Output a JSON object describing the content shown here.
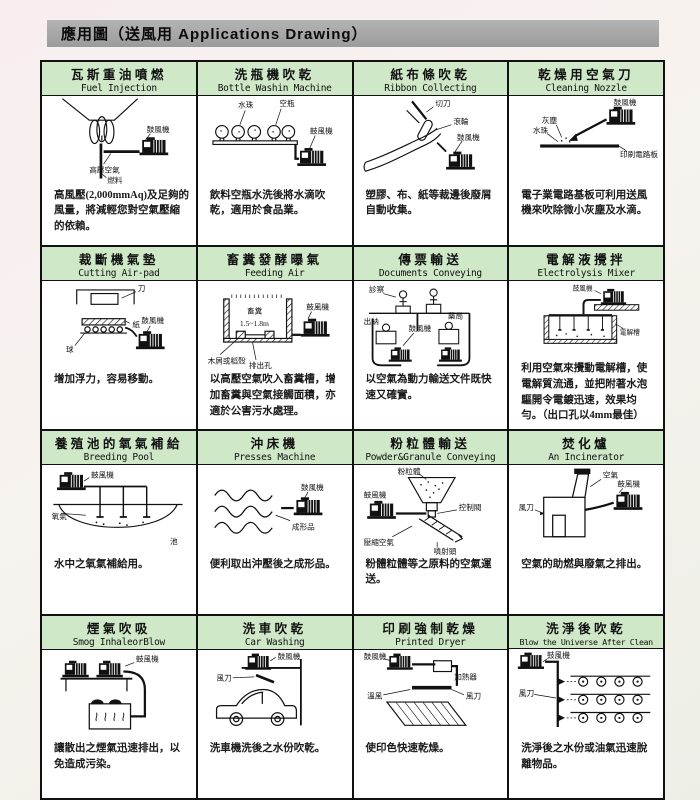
{
  "page": {
    "title": "應用圖（送風用 Applications Drawing）"
  },
  "colors": {
    "header_bar": "#a3a3a3",
    "title_band": "#cfe8c8",
    "border": "#111111",
    "paper": "#ffffff"
  },
  "cells": [
    {
      "title_zh": "瓦斯重油噴燃",
      "title_en": "Fuel Injection",
      "labels": [
        "鼓風機",
        "高壓空氣",
        "燃料"
      ],
      "desc": "高風壓(2,000mmAq)及足夠的風量，將減輕您對空氣壓縮的依賴。"
    },
    {
      "title_zh": "洗瓶機吹乾",
      "title_en": "Bottle Washin Machine",
      "labels": [
        "水珠",
        "空瓶",
        "鼓風機"
      ],
      "desc": "飲料空瓶水洗後將水滴吹乾，適用於食品業。"
    },
    {
      "title_zh": "紙布條吹乾",
      "title_en": "Ribbon Collecting",
      "labels": [
        "切刀",
        "滾輪",
        "鼓風機"
      ],
      "desc": "塑膠、布、紙等裁邊後廢屑自動收集。"
    },
    {
      "title_zh": "乾燥用空氣刀",
      "title_en": "Cleaning Nozzle",
      "labels": [
        "鼓風機",
        "灰塵",
        "水珠",
        "印刷電路板"
      ],
      "desc": "電子業電路基板可利用送風機來吹除微小灰塵及水滴。"
    },
    {
      "title_zh": "裁斷機氣墊",
      "title_en": "Cutting Air-pad",
      "labels": [
        "刀",
        "紙",
        "鼓風機",
        "球"
      ],
      "desc": "增加浮力，容易移動。"
    },
    {
      "title_zh": "畜糞發酵曝氣",
      "title_en": "Feeding Air",
      "labels": [
        "畜糞",
        "1.5~1.8m",
        "鼓風機",
        "木屑或稻殼",
        "排出孔"
      ],
      "desc": "以高壓空氣吹入畜糞槽，增加畜糞與空氣接觸面積，亦適於公害污水處理。"
    },
    {
      "title_zh": "傳票輸送",
      "title_en": "Documents Conveying",
      "labels": [
        "診察",
        "出納",
        "鼓風機",
        "藥局"
      ],
      "desc": "以空氣為動力輸送文件既快速又確實。"
    },
    {
      "title_zh": "電解液攪拌",
      "title_en": "Electrolysis Mixer",
      "labels": [
        "鼓風機",
        "電解槽"
      ],
      "desc": "利用空氣來攪動電解槽，使電解質流通，並把附著水泡驅開令電鍍迅速，效果均勻。（出口孔以4mm最佳）"
    },
    {
      "title_zh": "養殖池的氧氣補給",
      "title_en": "Breeding Pool",
      "labels": [
        "鼓風機",
        "氧氣",
        "池"
      ],
      "desc": "水中之氧氣補給用。"
    },
    {
      "title_zh": "沖床機",
      "title_en": "Presses Machine",
      "labels": [
        "鼓風機",
        "成形品"
      ],
      "desc": "便利取出沖壓後之成形品。"
    },
    {
      "title_zh": "粉粒體輸送",
      "title_en": "Powder&Granule Conveying",
      "labels": [
        "粉粒體",
        "鼓風機",
        "控制閥",
        "壓縮空氣",
        "噴射頭"
      ],
      "desc": "粉體粒體等之原料的空氣運送。"
    },
    {
      "title_zh": "焚化爐",
      "title_en": "An Incinerator",
      "labels": [
        "空氣",
        "鼓風機",
        "風刀"
      ],
      "desc": "空氣的助燃與廢氣之排出。"
    },
    {
      "title_zh": "煙氣吹吸",
      "title_en": "Smog InhaleorBlow",
      "labels": [
        "鼓風機"
      ],
      "desc": "讓散出之煙氣迅速排出，以免造成污染。"
    },
    {
      "title_zh": "洗車吹乾",
      "title_en": "Car Washing",
      "labels": [
        "鼓風機",
        "風刀"
      ],
      "desc": "洗車機洗後之水份吹乾。"
    },
    {
      "title_zh": "印刷強制乾燥",
      "title_en": "Printed Dryer",
      "labels": [
        "鼓風機",
        "加熱器",
        "溫風",
        "風刀"
      ],
      "desc": "使印色快速乾燥。"
    },
    {
      "title_zh": "洗淨後吹乾",
      "title_en": "Blow the Universe After Clean",
      "labels": [
        "鼓風機",
        "風刀"
      ],
      "desc": "洗淨後之水份或油氣迅速脫離物品。"
    }
  ]
}
